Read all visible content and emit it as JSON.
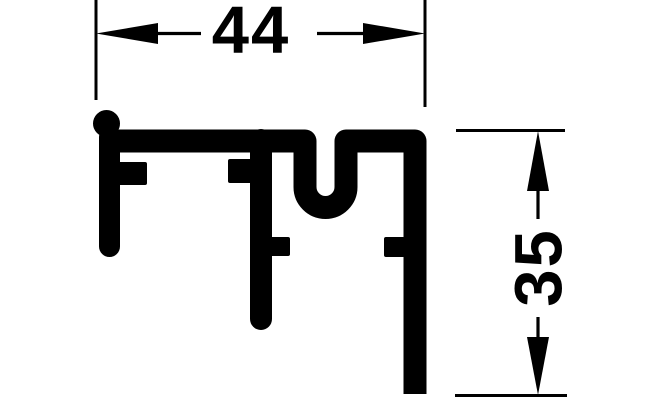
{
  "figure": {
    "background_color": "#ffffff",
    "ink_color": "#000000",
    "kind": "profile-cross-section-drawing",
    "dimensions": {
      "width": {
        "value": "44"
      },
      "height": {
        "value": "35"
      }
    }
  }
}
